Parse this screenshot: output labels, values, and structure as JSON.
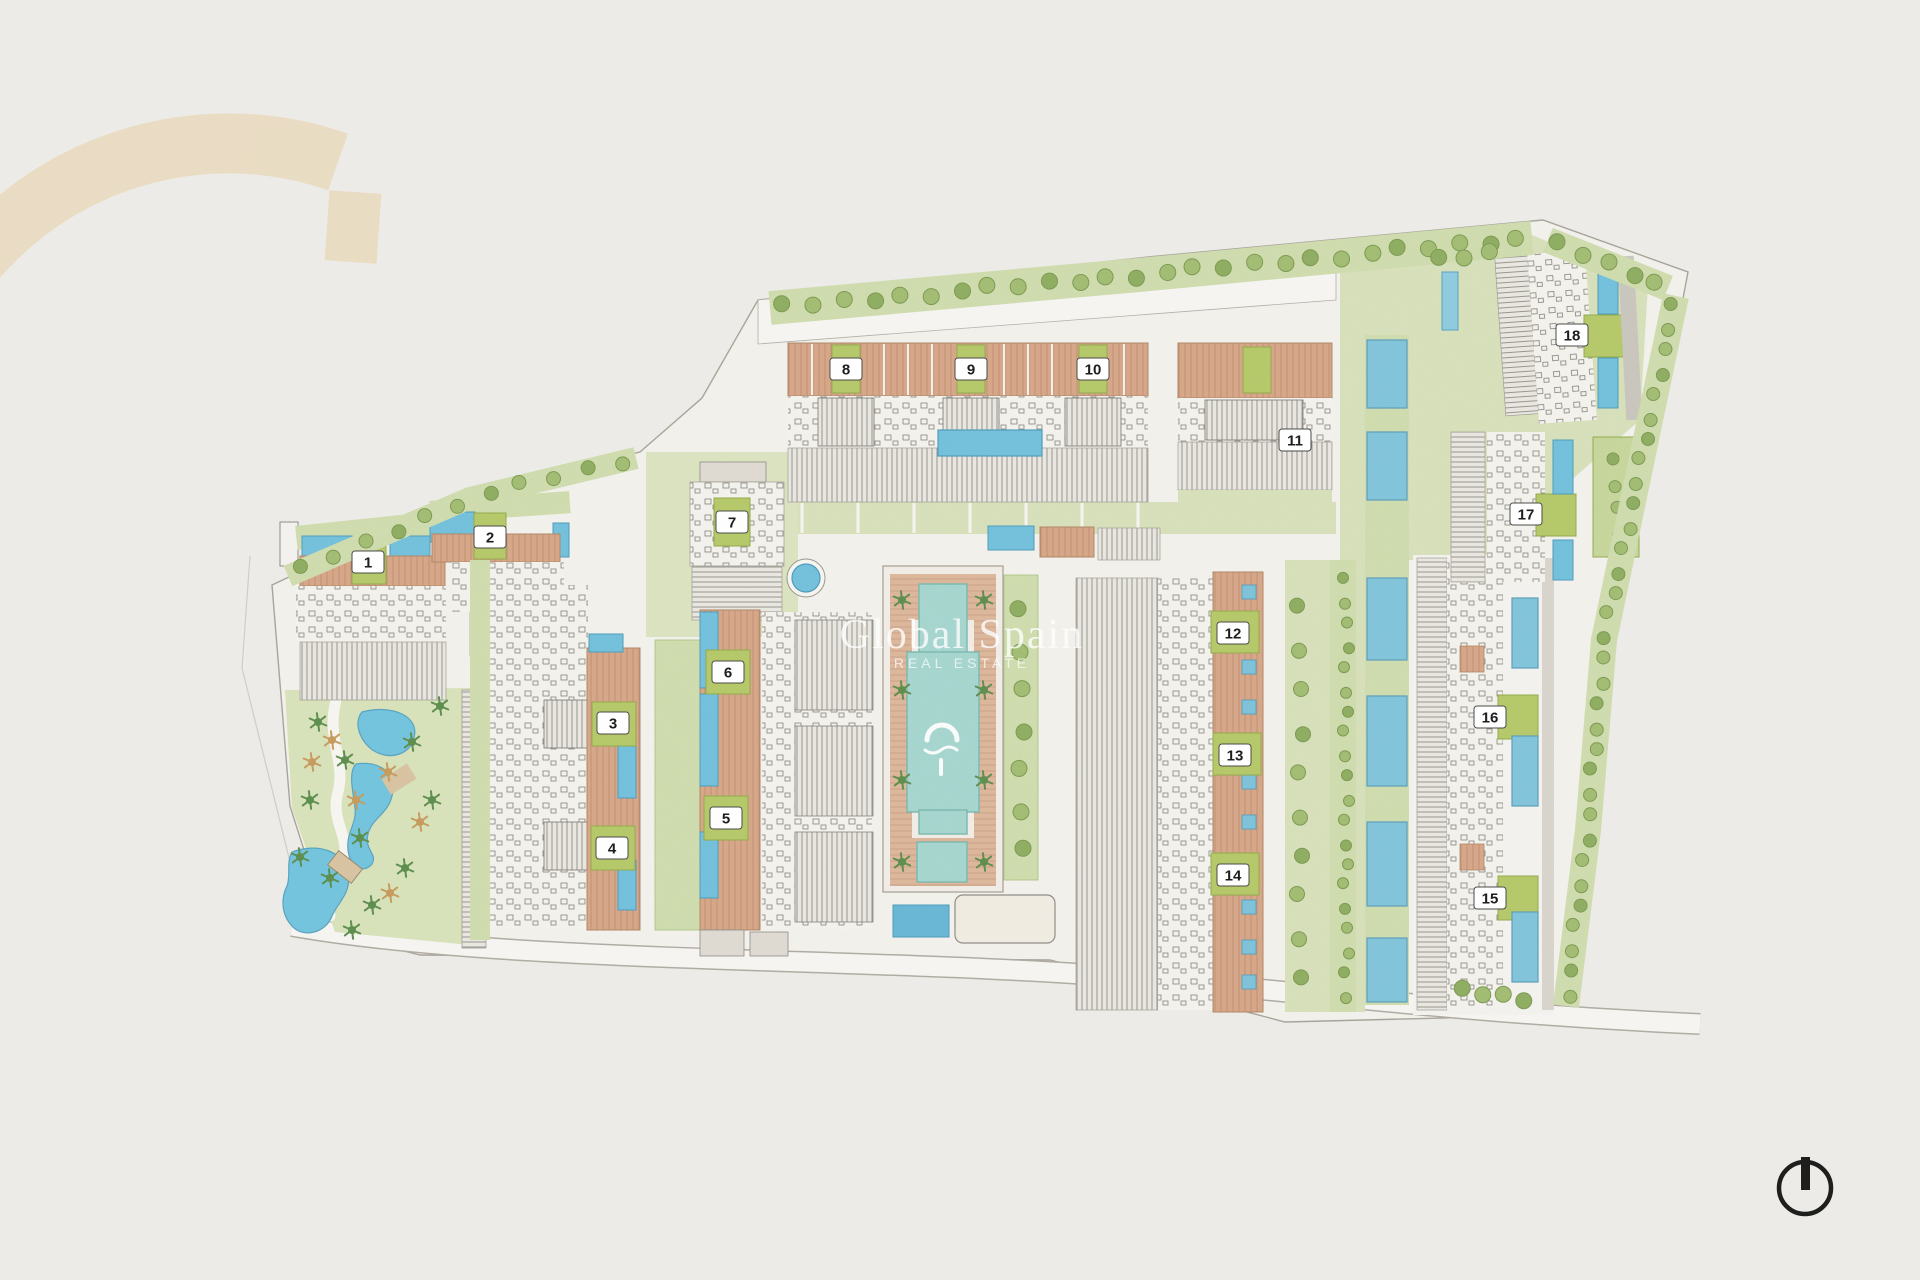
{
  "image_title": "Resort masterplan site drawing",
  "watermark": {
    "line1": "Global Spain",
    "line2": "REAL ESTATE"
  },
  "brand_logo": {
    "name": "arch-logo",
    "color": "#e9dcc0"
  },
  "compass": {
    "name": "north-indicator",
    "color": "#1d1d1b"
  },
  "colors": {
    "paper": "#edece8",
    "site_base": "#f2f1ec",
    "lawn": "#d7e0ba",
    "lawn_dark": "#c9d7a6",
    "tree_green": "#a3bd74",
    "tree_dark": "#7d9a52",
    "tree_tan": "#c79c5e",
    "water_blue": "#74c1dc",
    "water_teal": "#a6d6cf",
    "terracotta": "#d6a788",
    "olive_label": "#b5c86a",
    "deck_gray": "#dfdbd3",
    "ink": "#1c1c1c"
  },
  "plan": {
    "blocks": [
      {
        "n": "1",
        "x": 368,
        "y": 562
      },
      {
        "n": "2",
        "x": 490,
        "y": 537
      },
      {
        "n": "3",
        "x": 613,
        "y": 723
      },
      {
        "n": "4",
        "x": 612,
        "y": 848
      },
      {
        "n": "5",
        "x": 726,
        "y": 818
      },
      {
        "n": "6",
        "x": 728,
        "y": 672
      },
      {
        "n": "7",
        "x": 732,
        "y": 522
      },
      {
        "n": "8",
        "x": 846,
        "y": 369
      },
      {
        "n": "9",
        "x": 971,
        "y": 369
      },
      {
        "n": "10",
        "x": 1093,
        "y": 369
      },
      {
        "n": "11",
        "x": 1295,
        "y": 440
      },
      {
        "n": "12",
        "x": 1233,
        "y": 633
      },
      {
        "n": "13",
        "x": 1235,
        "y": 755
      },
      {
        "n": "14",
        "x": 1233,
        "y": 875
      },
      {
        "n": "15",
        "x": 1490,
        "y": 898
      },
      {
        "n": "16",
        "x": 1490,
        "y": 717
      },
      {
        "n": "17",
        "x": 1526,
        "y": 514
      },
      {
        "n": "18",
        "x": 1572,
        "y": 335
      }
    ],
    "features": [
      "lagoon-pool-park-west",
      "central-courtyard-cross-pool",
      "roundabout-pool",
      "tree-lined-north-boundary",
      "hedge-east-boundary",
      "perimeter-road-south"
    ]
  }
}
